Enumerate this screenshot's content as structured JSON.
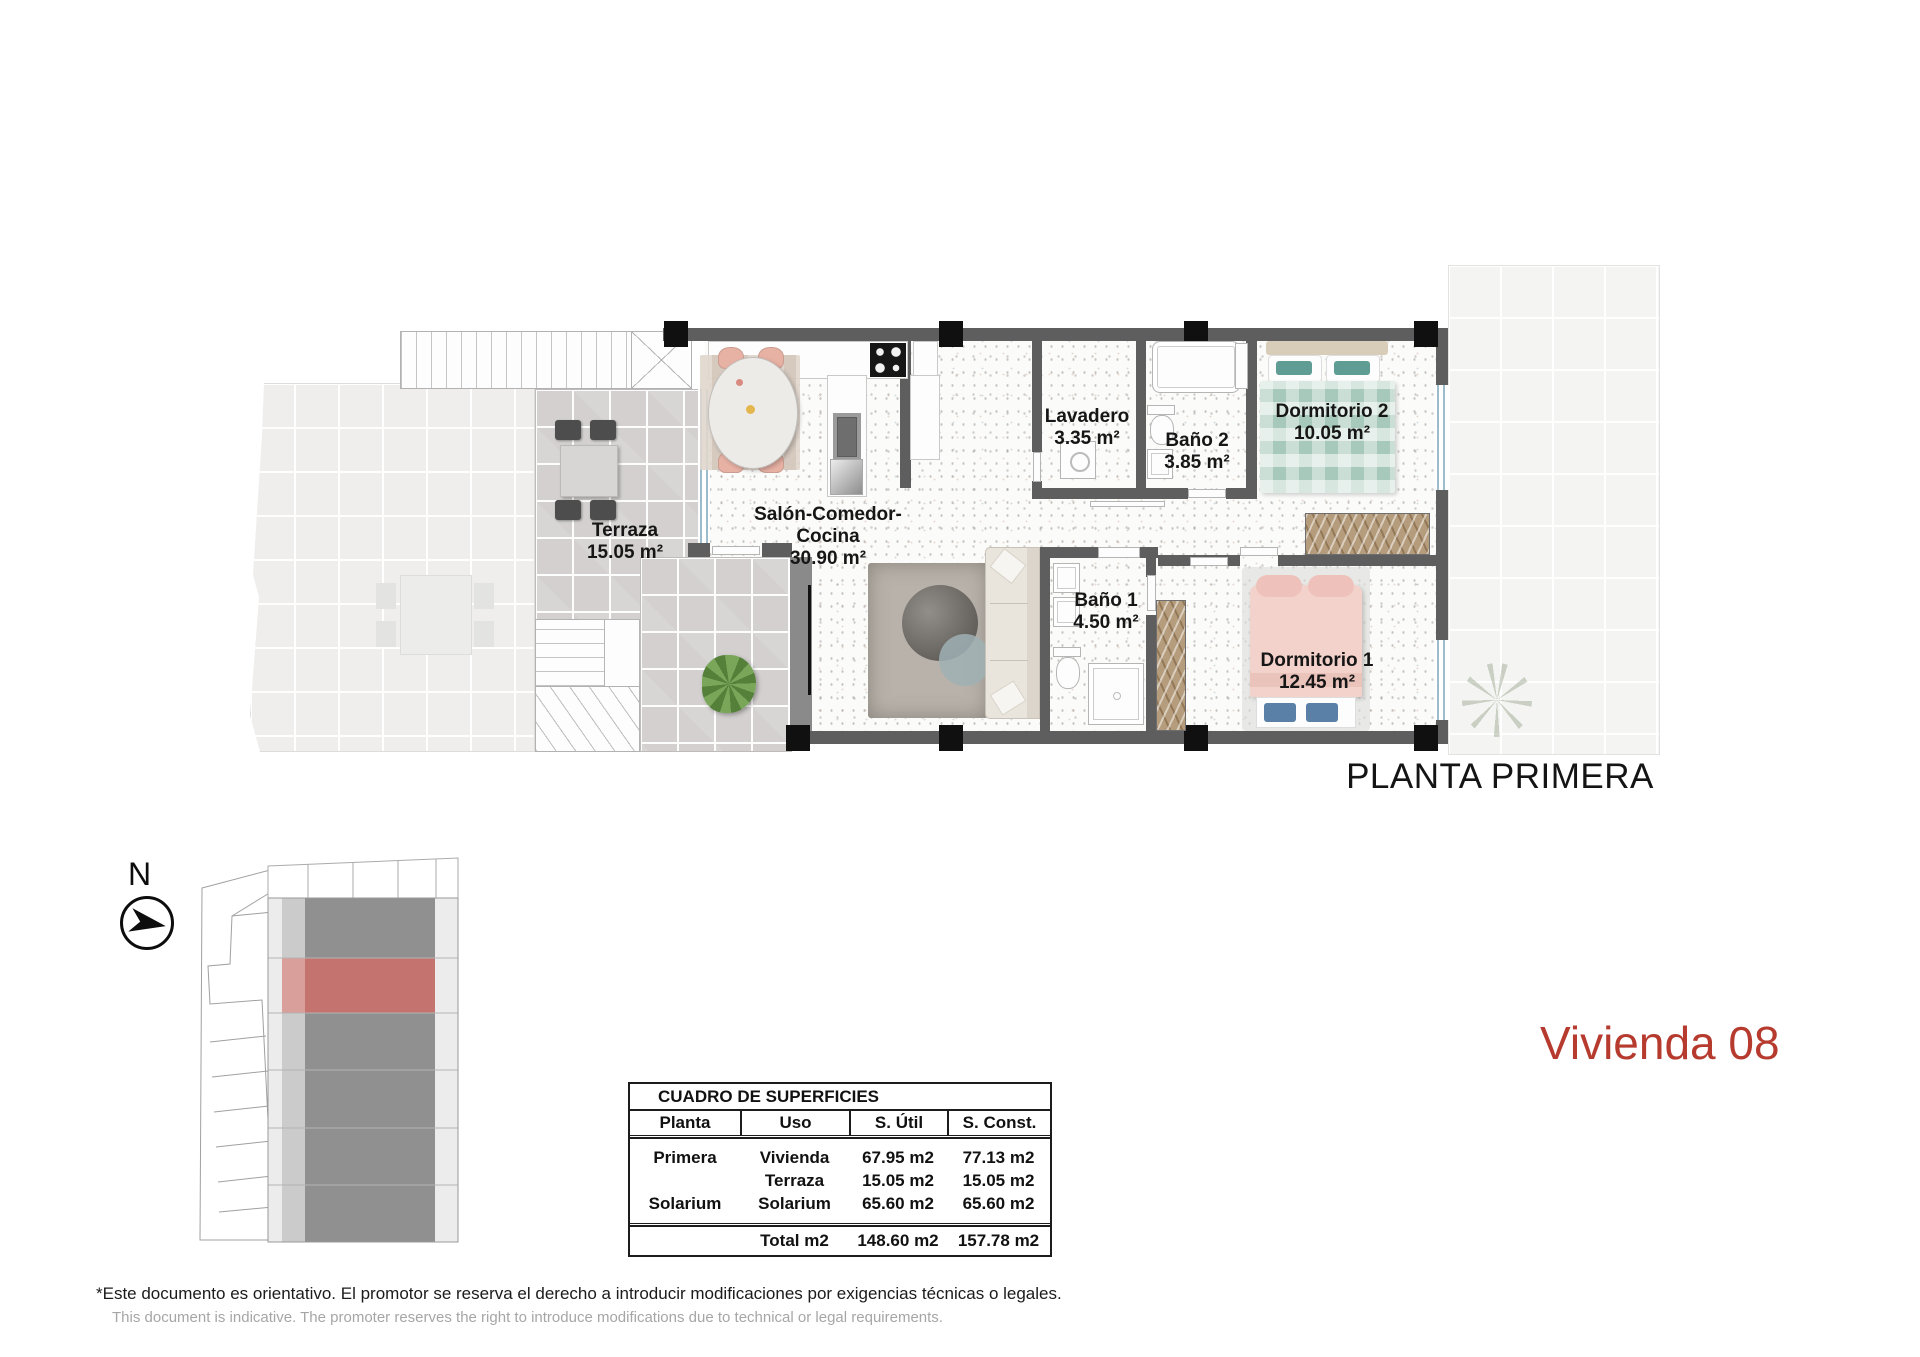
{
  "plan": {
    "title": "PLANTA PRIMERA",
    "rooms": {
      "terraza": {
        "name": "Terraza",
        "area": "15.05 m²"
      },
      "salon": {
        "name": "Salón-Comedor-Cocina",
        "area": "30.90 m²"
      },
      "lavadero": {
        "name": "Lavadero",
        "area": "3.35 m²"
      },
      "bano2": {
        "name": "Baño 2",
        "area": "3.85 m²"
      },
      "dormitorio2": {
        "name": "Dormitorio 2",
        "area": "10.05 m²"
      },
      "bano1": {
        "name": "Baño 1",
        "area": "4.50 m²"
      },
      "dormitorio1": {
        "name": "Dormitorio 1",
        "area": "12.45 m²"
      }
    }
  },
  "compass": {
    "label": "N"
  },
  "unit": {
    "title": "Vivienda 08",
    "accent_color": "#b63b2e",
    "site_highlight_color": "#c4736e",
    "site_highlight_light": "#d89f9b"
  },
  "surfaces_table": {
    "title": "CUADRO DE SUPERFICIES",
    "columns": [
      "Planta",
      "Uso",
      "S. Útil",
      "S. Const."
    ],
    "rows": [
      {
        "planta": "Primera",
        "uso": "Vivienda",
        "util": "67.95 m2",
        "const": "77.13 m2"
      },
      {
        "planta": "",
        "uso": "Terraza",
        "util": "15.05 m2",
        "const": "15.05 m2"
      },
      {
        "planta": "Solarium",
        "uso": "Solarium",
        "util": "65.60 m2",
        "const": "65.60 m2"
      }
    ],
    "total": {
      "planta": "",
      "label": "Total m2",
      "util": "148.60 m2",
      "const": "157.78 m2"
    }
  },
  "disclaimer": {
    "es": "*Este documento es orientativo. El promotor se reserva el derecho a introducir modificaciones por exigencias técnicas o legales.",
    "en": "This document is indicative. The promoter reserves the right to introduce modifications due to technical or legal requirements."
  }
}
